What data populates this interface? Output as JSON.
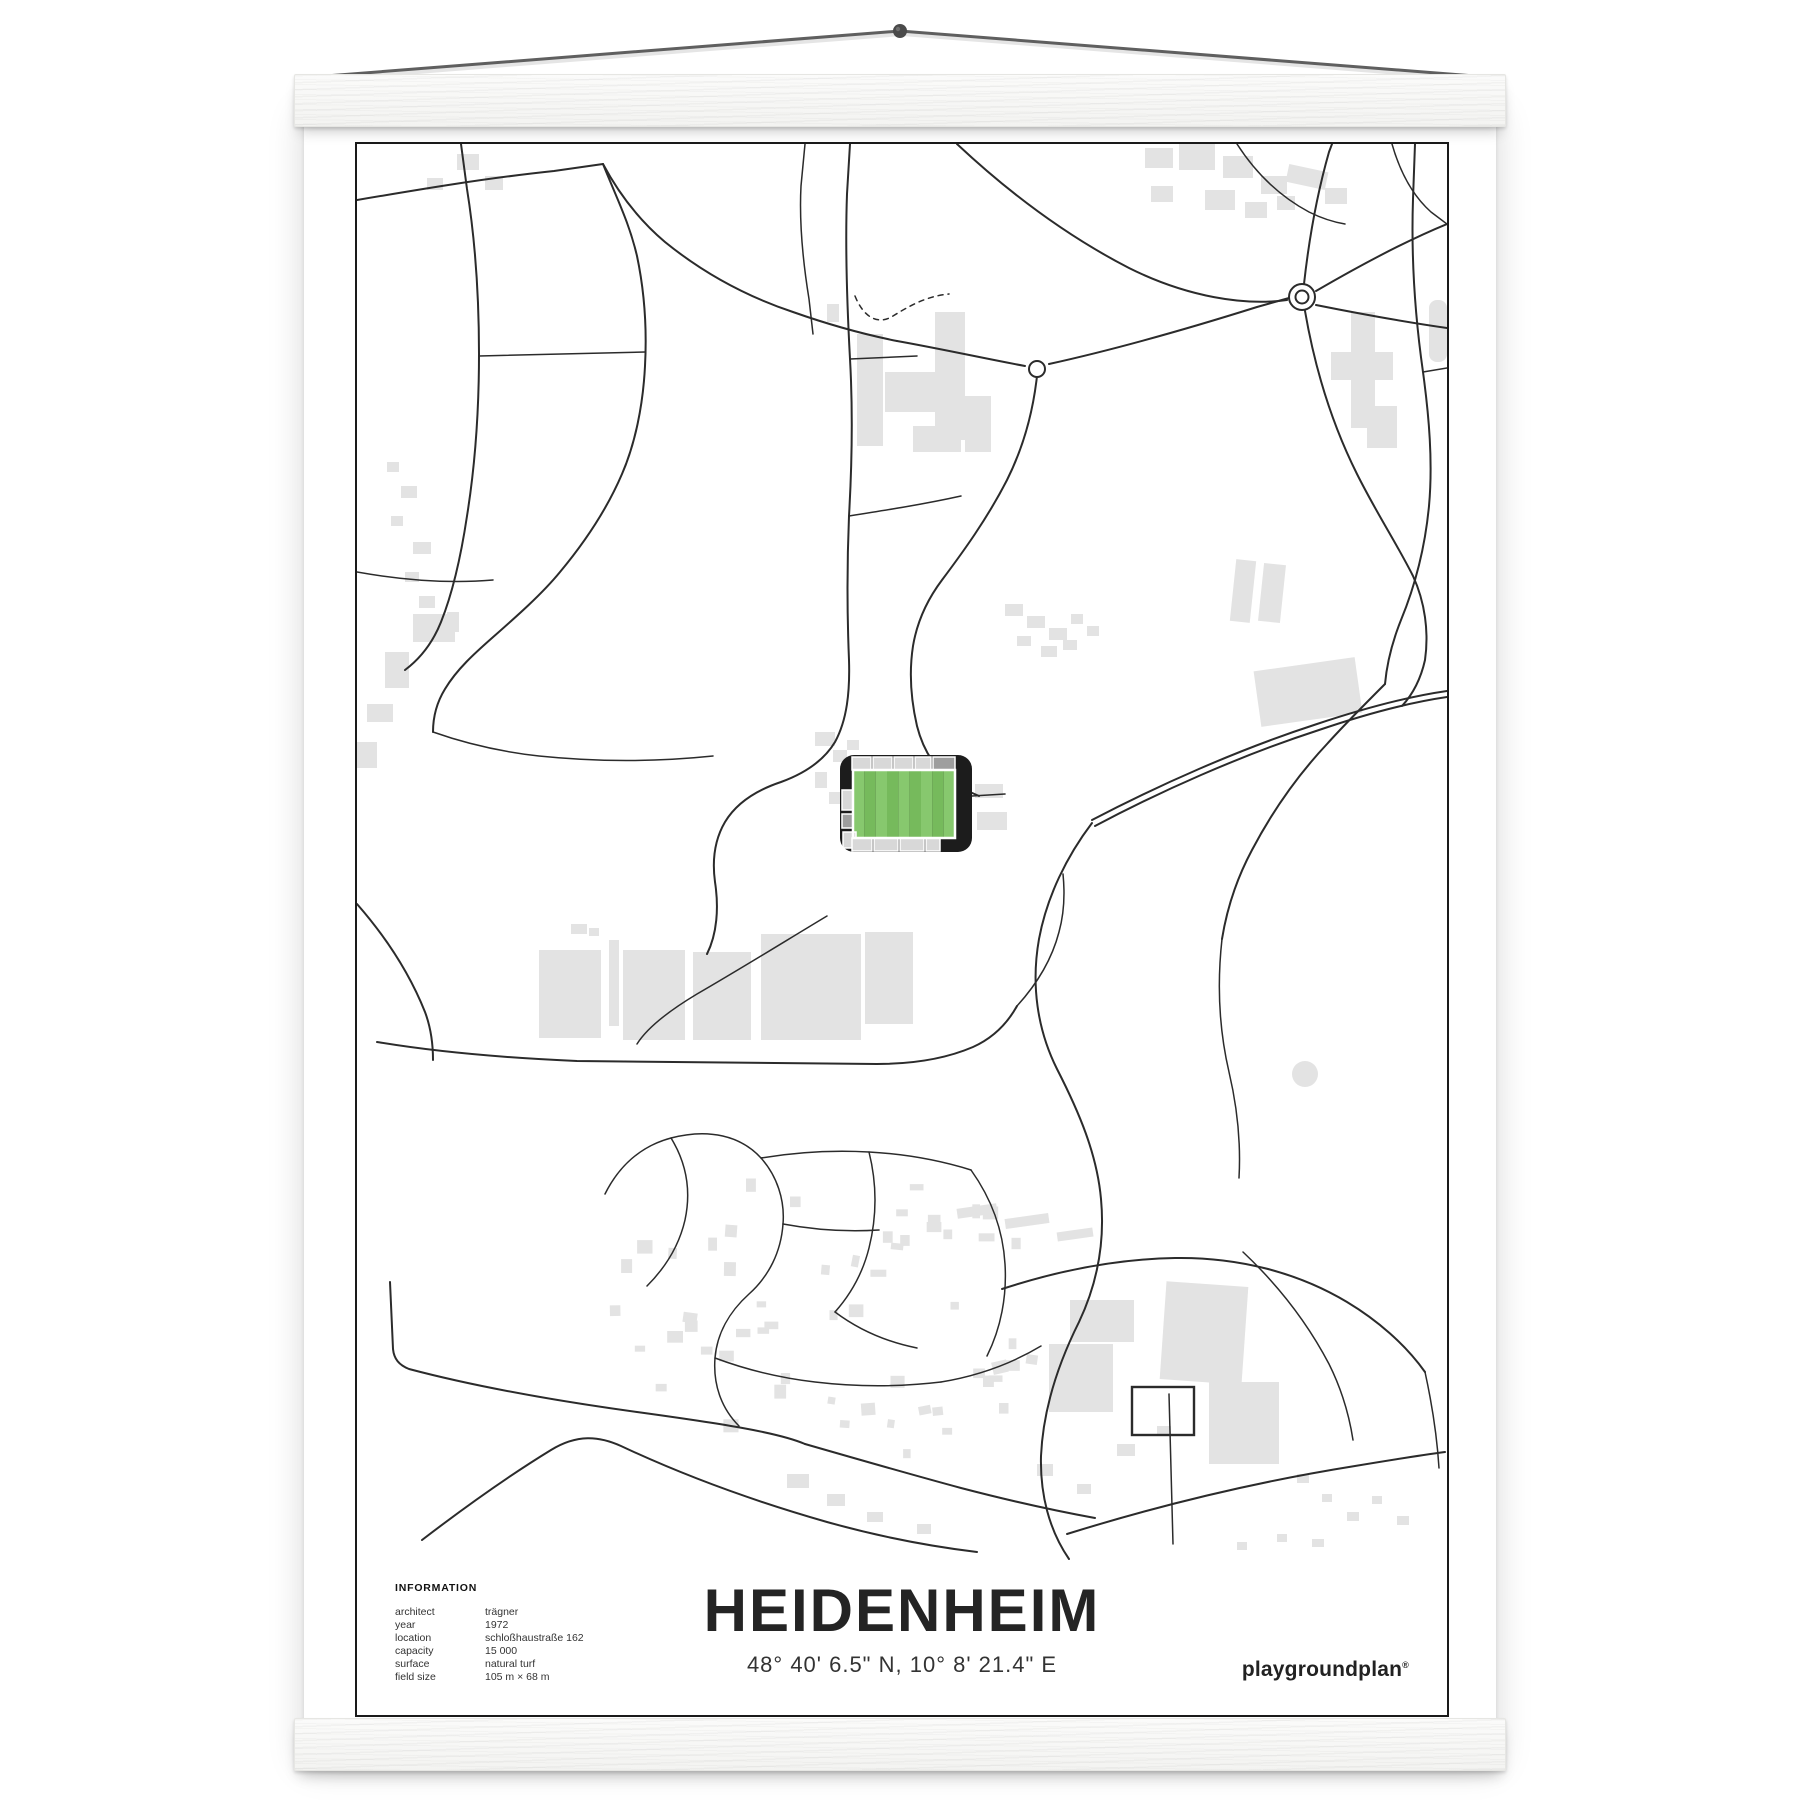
{
  "poster": {
    "title": "HEIDENHEIM",
    "coordinates": "48° 40' 6.5\" N, 10° 8' 21.4\" E",
    "brand": {
      "name": "playgroundplan",
      "mark": "®"
    },
    "info": {
      "heading": "INFORMATION",
      "rows": [
        {
          "label": "architect",
          "value": "trägner"
        },
        {
          "label": "year",
          "value": "1972"
        },
        {
          "label": "location",
          "value": "schloßhaustraße 162"
        },
        {
          "label": "capacity",
          "value": "15 000"
        },
        {
          "label": "surface",
          "value": "natural turf"
        },
        {
          "label": "field size",
          "value": "105 m × 68 m"
        }
      ]
    }
  },
  "map": {
    "style": "minimal street map of Heidenheim with football stadium highlighted",
    "features": [
      "roads",
      "building-footprints",
      "two-roundabouts",
      "stadium-with-green-pitch",
      "pond"
    ]
  },
  "colors": {
    "frame": "#1a1a1a",
    "road": "#2b2b2b",
    "building": "#e3e3e3",
    "stand_dark": "#1c1c1c",
    "seat_light": "#d8d8d8",
    "seat_mid": "#9e9e9e",
    "pitch_light": "#87c86e",
    "pitch_dark": "#76ba5c",
    "string": "#5f5f5f",
    "nail": "#4a4a4a"
  }
}
